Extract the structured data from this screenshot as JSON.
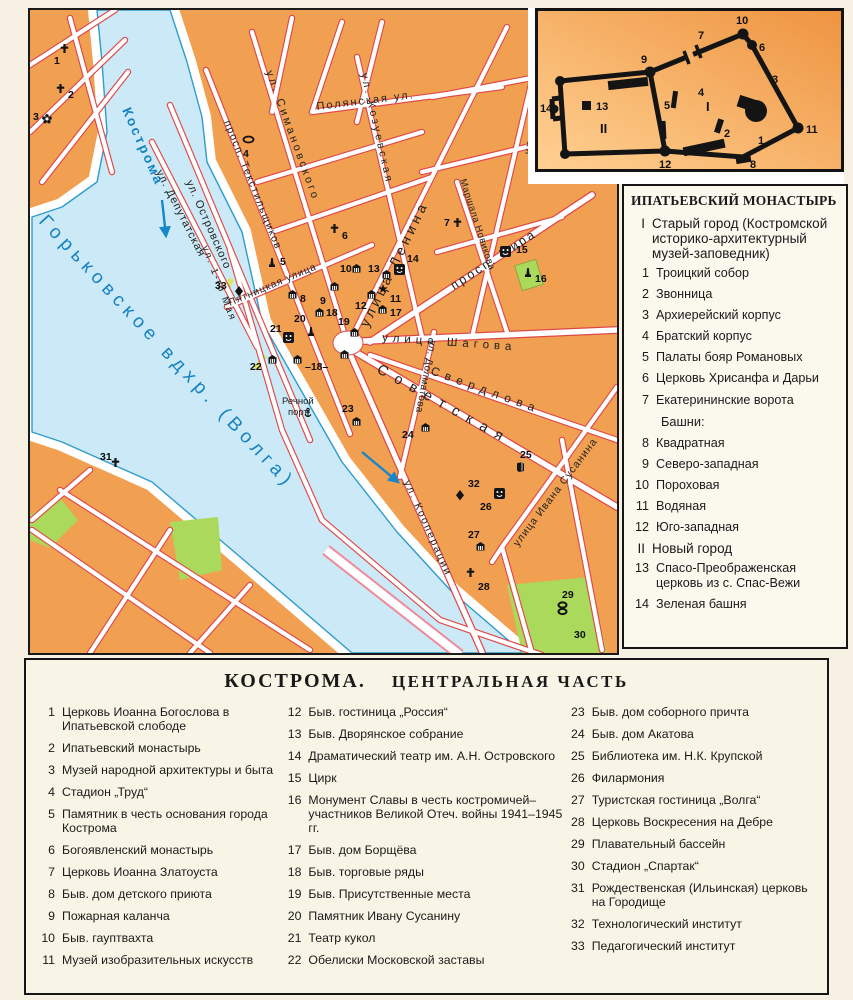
{
  "map": {
    "streets": {
      "kostroma": "Кострома",
      "volga": "Горьковское  вдхр.  (Волга)",
      "polyanskaya": "Полянская  ул.",
      "simanovskogo": "ул. Симановского",
      "tekstilshchikov": "просп. Текстильщиков",
      "deputatskaya": "ул. Депутатская",
      "ostrovskogo": "ул. Островского",
      "kozuevskaya": "ул. Козуевская",
      "lenina": "улица Ленина",
      "kalinovskaya": "ул. Калиновская",
      "mira": "просп. Мира",
      "novikova": "Маршала Новикова",
      "shagova": "улица Шагова",
      "sverdlova": "Свердлова",
      "sovetskaya": "Советская",
      "dolmatova": "ул. Долматова",
      "kooperatsii": "ул. Кооперации",
      "susanina": "улица Ивана Сусанина",
      "pyatnitskaya": "Пятницкая улица",
      "maya": "ул. 1-го Мая",
      "port1": "Речной",
      "port2": "порт"
    },
    "marker_nums": {
      "m1": "1",
      "m2": "2",
      "m3": "3",
      "m4": "4",
      "m5": "5",
      "m6": "6",
      "m7": "7",
      "m8": "8",
      "m9": "9",
      "m10": "10",
      "m11": "11",
      "m12": "12",
      "m13": "13",
      "m14": "14",
      "m15": "15",
      "m16": "16",
      "m17": "17",
      "m18": "18",
      "m18b": "–18–",
      "m19": "19",
      "m20": "20",
      "m21": "21",
      "m22": "22",
      "m23": "23",
      "m24": "24",
      "m25": "25",
      "m26": "26",
      "m27": "27",
      "m28": "28",
      "m29": "29",
      "m30": "30",
      "m31": "31",
      "m32": "32",
      "m33": "33"
    }
  },
  "inset": {
    "nums": {
      "n1": "1",
      "n2": "2",
      "n3": "3",
      "n4": "4",
      "n5": "5",
      "n6": "6",
      "n7": "7",
      "n8": "8",
      "n9": "9",
      "n10": "10",
      "n11": "11",
      "n12": "12",
      "n13": "13",
      "n14": "14",
      "rI": "I",
      "rII": "II"
    }
  },
  "legend_monastery": {
    "title": "ИПАТЬЕВСКИЙ МОНАСТЫРЬ",
    "group1": {
      "n": "I",
      "t": "Старый город (Костромской историко-архитектурный музей-заповедник)"
    },
    "items1": [
      {
        "n": "1",
        "t": "Троицкий собор"
      },
      {
        "n": "2",
        "t": "Звонница"
      },
      {
        "n": "3",
        "t": "Архиерейский корпус"
      },
      {
        "n": "4",
        "t": "Братский корпус"
      },
      {
        "n": "5",
        "t": "Палаты бояр Романовых"
      },
      {
        "n": "6",
        "t": "Церковь Хрисанфа и Дарьи"
      },
      {
        "n": "7",
        "t": "Екатерининские ворота"
      }
    ],
    "towers_head": "Башни:",
    "items2": [
      {
        "n": "8",
        "t": "Квадратная"
      },
      {
        "n": "9",
        "t": "Северо-западная"
      },
      {
        "n": "10",
        "t": "Пороховая"
      },
      {
        "n": "11",
        "t": "Водяная"
      },
      {
        "n": "12",
        "t": "Юго-западная"
      }
    ],
    "group2": {
      "n": "II",
      "t": "Новый город"
    },
    "items3": [
      {
        "n": "13",
        "t": "Спасо-Преображенская церковь из с. Спас-Вежи"
      },
      {
        "n": "14",
        "t": "Зеленая башня"
      }
    ]
  },
  "legend_city": {
    "title1": "КОСТРОМА.",
    "title2": "ЦЕНТРАЛЬНАЯ ЧАСТЬ",
    "col1": [
      {
        "n": "1",
        "t": "Церковь Иоанна Богослова в Ипатьевской слободе"
      },
      {
        "n": "2",
        "t": "Ипатьевский монастырь"
      },
      {
        "n": "3",
        "t": "Музей народной архитектуры и быта"
      },
      {
        "n": "4",
        "t": "Стадион „Труд“"
      },
      {
        "n": "5",
        "t": "Памятник в честь основания города Кострома"
      },
      {
        "n": "6",
        "t": "Богоявленский монастырь"
      },
      {
        "n": "7",
        "t": "Церковь Иоанна Златоуста"
      },
      {
        "n": "8",
        "t": "Быв. дом детского приюта"
      },
      {
        "n": "9",
        "t": "Пожарная каланча"
      },
      {
        "n": "10",
        "t": "Быв. гауптвахта"
      },
      {
        "n": "11",
        "t": "Музей изобразительных искусств"
      }
    ],
    "col2": [
      {
        "n": "12",
        "t": "Быв. гостиница „Россия“"
      },
      {
        "n": "13",
        "t": "Быв. Дворянское собрание"
      },
      {
        "n": "14",
        "t": "Драматический театр им. А.Н. Островского"
      },
      {
        "n": "15",
        "t": "Цирк"
      },
      {
        "n": "16",
        "t": "Монумент Славы в честь костромичей–участников Великой Отеч. войны 1941–1945 гг."
      },
      {
        "n": "17",
        "t": "Быв. дом Борщёва"
      },
      {
        "n": "18",
        "t": "Быв. торговые ряды"
      },
      {
        "n": "19",
        "t": "Быв. Присутственные места"
      },
      {
        "n": "20",
        "t": "Памятник Ивану Сусанину"
      },
      {
        "n": "21",
        "t": "Театр кукол"
      },
      {
        "n": "22",
        "t": "Обелиски Московской заставы"
      }
    ],
    "col3": [
      {
        "n": "23",
        "t": "Быв. дом соборного причта"
      },
      {
        "n": "24",
        "t": "Быв. дом Акатова"
      },
      {
        "n": "25",
        "t": "Библиотека им. Н.К. Крупской"
      },
      {
        "n": "26",
        "t": "Филармония"
      },
      {
        "n": "27",
        "t": "Туристская гостиница „Волга“"
      },
      {
        "n": "28",
        "t": "Церковь Воскресения на Дебре"
      },
      {
        "n": "29",
        "t": "Плавательный бассейн"
      },
      {
        "n": "30",
        "t": "Стадион „Спартак“"
      },
      {
        "n": "31",
        "t": "Рождественская (Ильинская) церковь на Городище"
      },
      {
        "n": "32",
        "t": "Технологический институт"
      },
      {
        "n": "33",
        "t": "Педагогический институт"
      }
    ]
  }
}
